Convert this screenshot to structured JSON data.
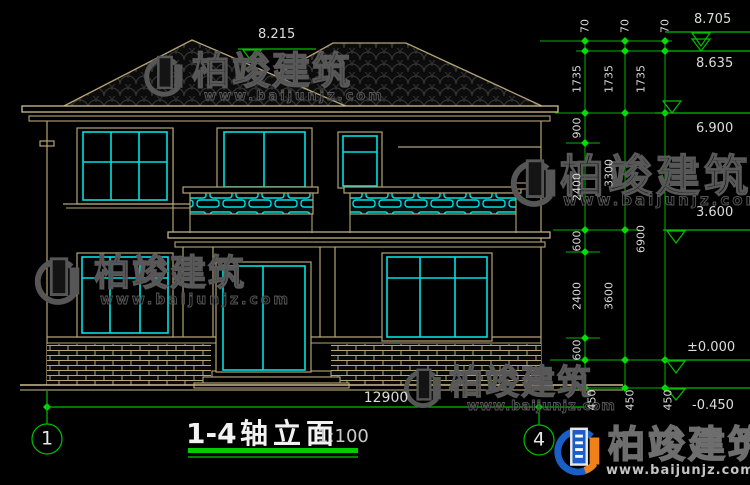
{
  "drawing": {
    "title": {
      "range": "1-4",
      "name": "轴立面",
      "scale": "1:100"
    },
    "axis_bubbles": {
      "left": "1",
      "right": "4"
    },
    "overall_width": "12900",
    "levels": {
      "ridge_front": "8.215",
      "ridge_top": "8.705",
      "ridge_under": "8.635",
      "eave": "6.900",
      "floor2": "3.600",
      "floor1": "±0.000",
      "ground": "-0.450"
    },
    "dims": {
      "top70": [
        "70",
        "70",
        "70"
      ],
      "col1": [
        "1735",
        "900",
        "2400",
        "600",
        "2400",
        "600"
      ],
      "col2": [
        "1735",
        "3300",
        "3600"
      ],
      "col3": [
        "1735",
        "6900"
      ],
      "base450": [
        "450",
        "450",
        "450"
      ]
    },
    "colors": {
      "background": "#000000",
      "wall_line": "#b5a476",
      "window_frame": "#00e1e1",
      "dimension_green": "#00c000",
      "text_white": "#dcdcdc"
    }
  },
  "watermark": {
    "brand": "柏竣建筑",
    "url": "www.baijunjz.com"
  }
}
